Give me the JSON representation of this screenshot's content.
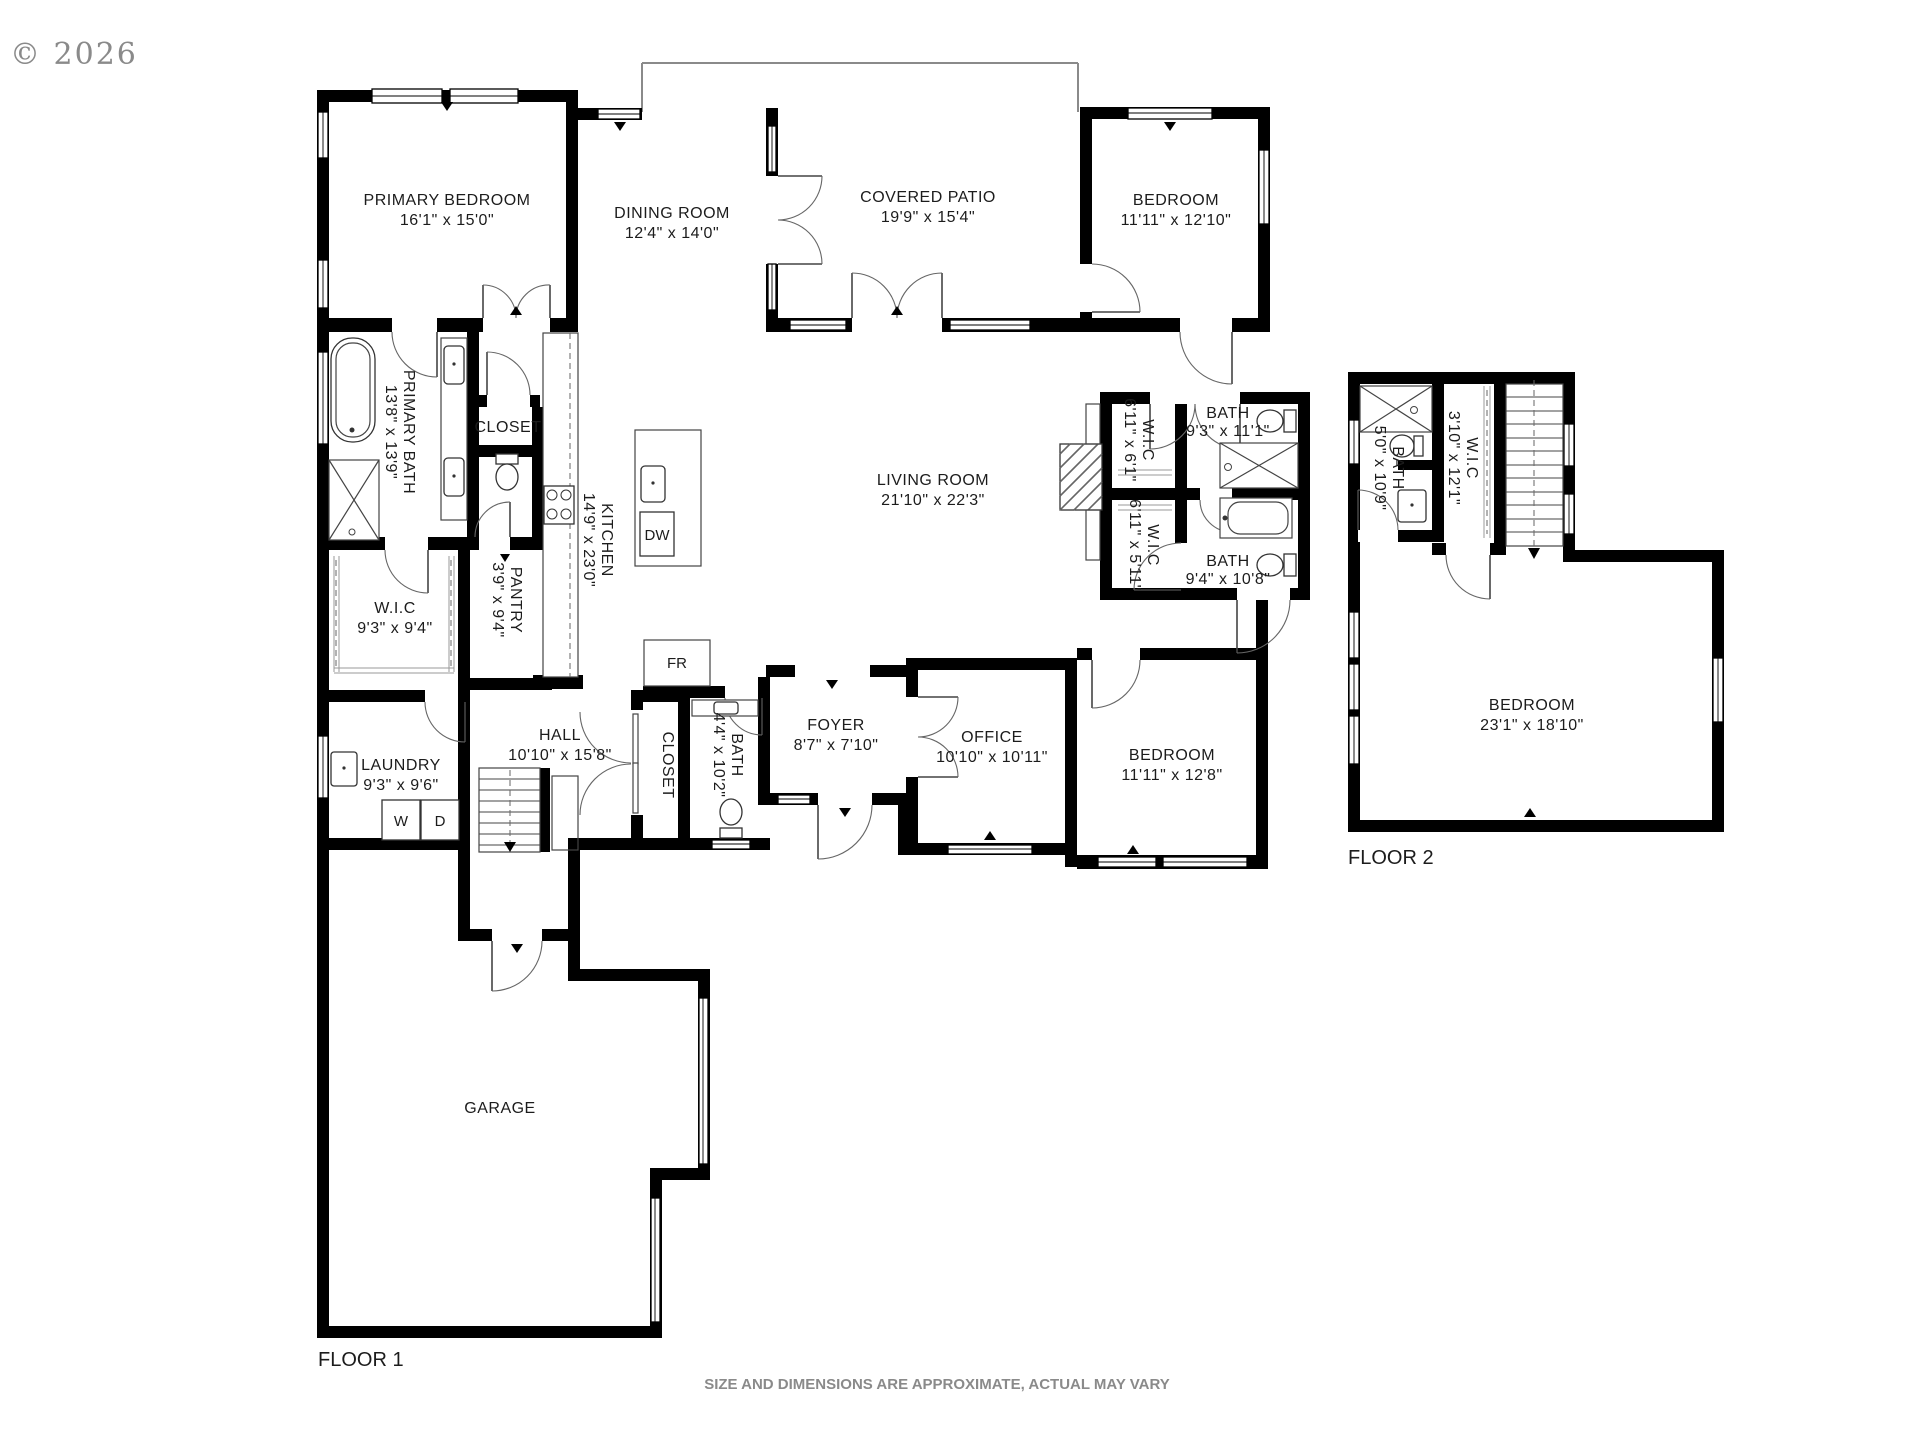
{
  "meta": {
    "copyright": "© 2026",
    "disclaimer": "SIZE AND DIMENSIONS ARE APPROXIMATE, ACTUAL MAY VARY"
  },
  "floors": {
    "floor1": "FLOOR 1",
    "floor2": "FLOOR 2"
  },
  "colors": {
    "wall": "#000000",
    "muted_text": "#8a8a8a",
    "door_arc": "#666666"
  },
  "appliances": {
    "washer": "W",
    "dryer": "D",
    "fridge": "FR",
    "dishwasher": "DW"
  },
  "rooms": {
    "primary_bedroom": {
      "name": "PRIMARY BEDROOM",
      "dims": "16'1\" x 15'0\""
    },
    "dining_room": {
      "name": "DINING ROOM",
      "dims": "12'4\" x 14'0\""
    },
    "covered_patio": {
      "name": "COVERED PATIO",
      "dims": "19'9\" x 15'4\""
    },
    "bedroom_top": {
      "name": "BEDROOM",
      "dims": "11'11\" x 12'10\""
    },
    "primary_bath": {
      "name": "PRIMARY BATH",
      "dims": "13'8\" x 13'9\""
    },
    "primary_closet": {
      "name": "CLOSET"
    },
    "kitchen": {
      "name": "KITCHEN",
      "dims": "14'9\" x 23'0\""
    },
    "pantry": {
      "name": "PANTRY",
      "dims": "3'9\" x 9'4\""
    },
    "primary_wic": {
      "name": "W.I.C",
      "dims": "9'3\" x 9'4\""
    },
    "living_room": {
      "name": "LIVING ROOM",
      "dims": "21'10\" x 22'3\""
    },
    "wic_upper": {
      "name": "W.I.C",
      "dims": "6'11\" x 6'1\""
    },
    "bath_upper": {
      "name": "BATH",
      "dims": "9'3\" x 11'1\""
    },
    "wic_lower": {
      "name": "W.I.C",
      "dims": "6'11\" x 5'11\""
    },
    "bath_lower": {
      "name": "BATH",
      "dims": "9'4\" x 10'8\""
    },
    "laundry": {
      "name": "LAUNDRY",
      "dims": "9'3\" x 9'6\""
    },
    "hall": {
      "name": "HALL",
      "dims": "10'10\" x 15'8\""
    },
    "hall_closet": {
      "name": "CLOSET"
    },
    "hall_bath": {
      "name": "BATH",
      "dims": "4'4\" x 10'2\""
    },
    "foyer": {
      "name": "FOYER",
      "dims": "8'7\" x 7'10\""
    },
    "office": {
      "name": "OFFICE",
      "dims": "10'10\" x 10'11\""
    },
    "bedroom_main": {
      "name": "BEDROOM",
      "dims": "11'11\" x 12'8\""
    },
    "garage": {
      "name": "GARAGE"
    },
    "f2_bath": {
      "name": "BATH",
      "dims": "5'0\" x 10'9\""
    },
    "f2_wic": {
      "name": "W.I.C",
      "dims": "3'10\" x 12'1\""
    },
    "f2_bedroom": {
      "name": "BEDROOM",
      "dims": "23'1\" x 18'10\""
    }
  }
}
